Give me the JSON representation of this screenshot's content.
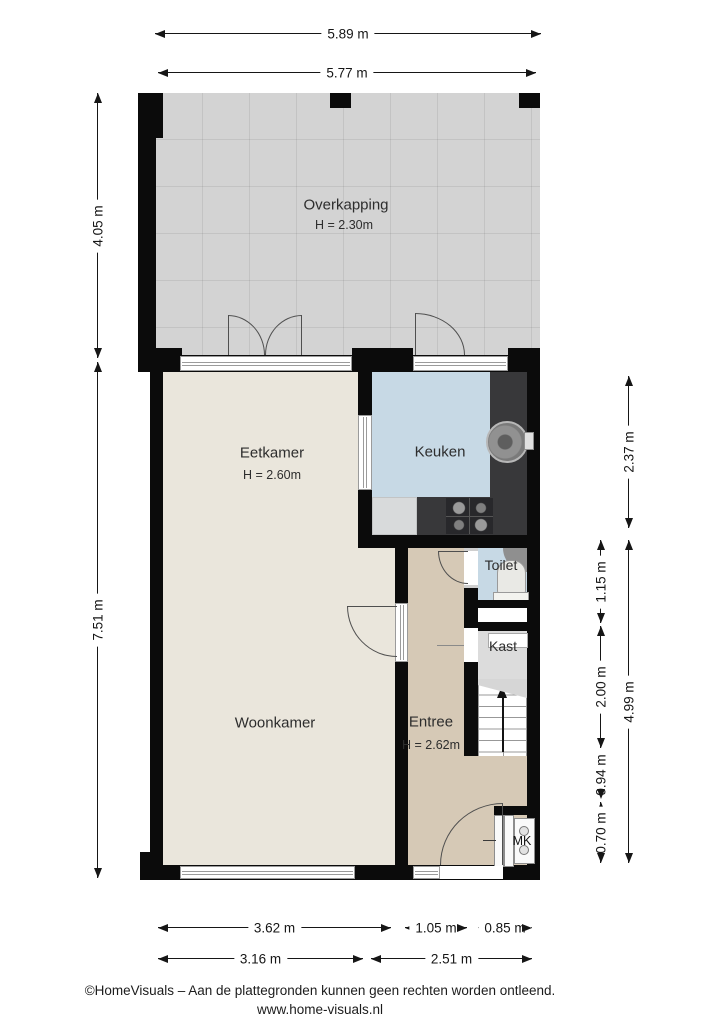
{
  "plan": {
    "rooms": {
      "overkapping": {
        "label": "Overkapping",
        "height": "H = 2.30m"
      },
      "eetkamer": {
        "label": "Eetkamer",
        "height": "H = 2.60m"
      },
      "keuken": {
        "label": "Keuken"
      },
      "toilet": {
        "label": "Toilet"
      },
      "kast": {
        "label": "Kast"
      },
      "woonkamer": {
        "label": "Woonkamer"
      },
      "entree": {
        "label": "Entree",
        "height": "H = 2.62m"
      },
      "mk": {
        "label": "MK"
      }
    },
    "dims": {
      "top_outer": "5.89 m",
      "top_inner": "5.77 m",
      "left_overkapping": "4.05 m",
      "left_house": "7.51 m",
      "right_keuken": "2.37 m",
      "right_toilet": "1.15 m",
      "right_kast_trap": "2.00 m",
      "right_hal": "0.94 m",
      "right_mk": "0.70 m",
      "right_total": "4.99 m",
      "bottom_woonkamer": "3.62 m",
      "bottom_entree": "1.05 m",
      "bottom_mk": "0.85 m",
      "bottom_inner_left": "3.16 m",
      "bottom_inner_right": "2.51 m"
    },
    "footer": {
      "line1": "©HomeVisuals – Aan de plattegronden kunnen geen rechten worden ontleend.",
      "line2": "www.home-visuals.nl"
    },
    "colors": {
      "wall": "#0b0b0b",
      "floor_living": "#eae6dc",
      "floor_kitchen_toilet": "#c7d9e5",
      "floor_entree": "#d6c9b6",
      "floor_overkapping": "#d3d3d3",
      "floor_kast": "#dcdcdc",
      "counter": "#38383a"
    }
  }
}
